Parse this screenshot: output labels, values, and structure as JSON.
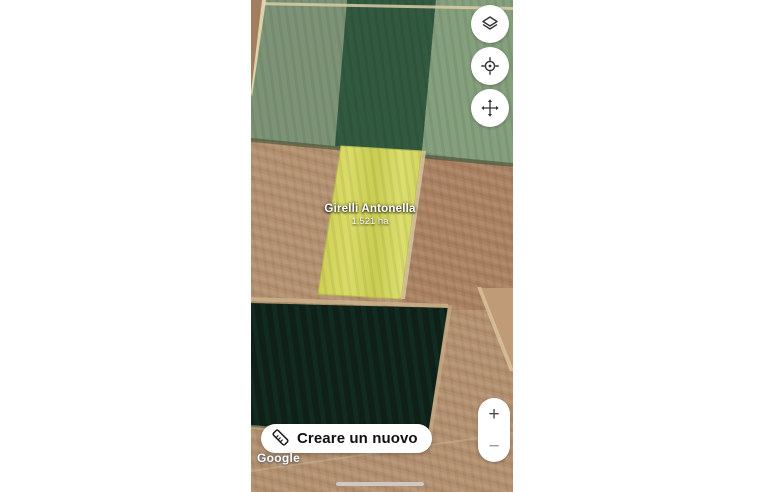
{
  "parcel_label": {
    "name": "Girelli Antonella",
    "area": "1.521 ha"
  },
  "map_controls": {
    "layers_icon": "layers-icon",
    "gps_icon": "gps-target-icon",
    "pan_icon": "pan-arrows-icon",
    "zoom_in_label": "+",
    "zoom_out_label": "−"
  },
  "footer": {
    "create_button_label": "Creare un nuovo",
    "create_button_icon": "ruler-icon",
    "attribution": "Google"
  },
  "colors": {
    "button-bg": "#ffffff",
    "button-text": "#111111",
    "parcel-yellow": "#d6d75f",
    "field-green": "#7c9376",
    "field-green-dark": "#315a40",
    "field-brown": "#b3906f",
    "field-dark": "#0e2018"
  }
}
